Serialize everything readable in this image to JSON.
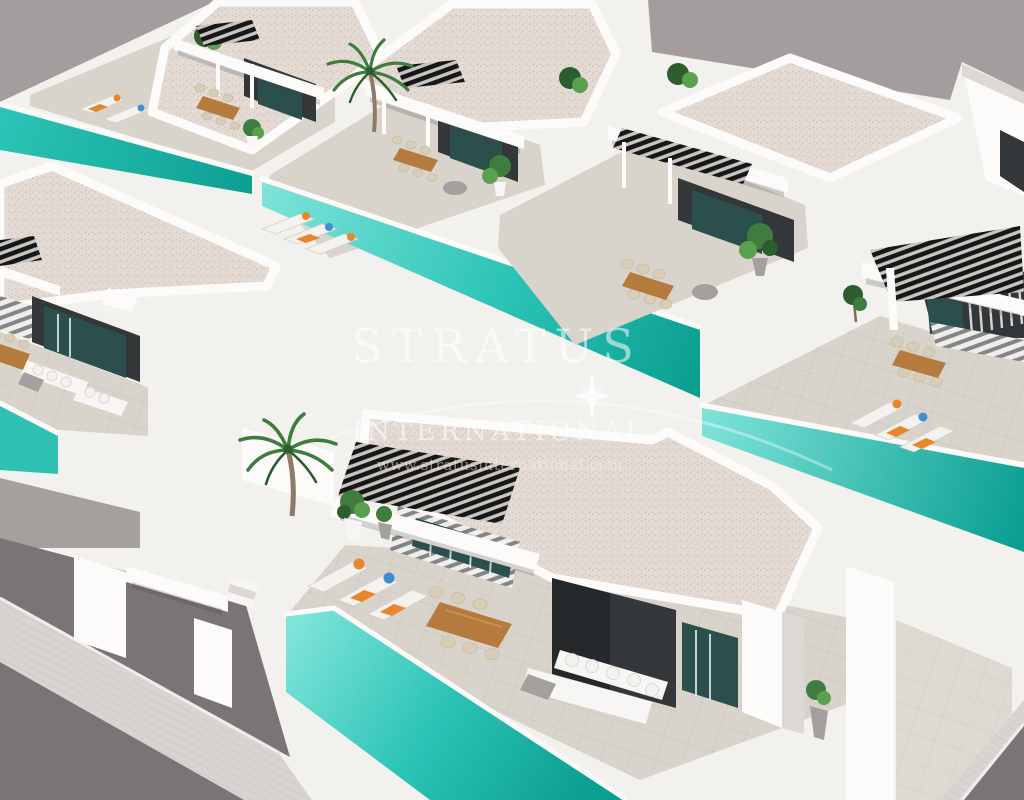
{
  "image_type": "3d-architectural-render",
  "watermark": {
    "brand_line1": "STRATUS",
    "brand_line2": "INTERNATIONAL",
    "website": "www.stratusinternational.com"
  },
  "scene": {
    "description": "Aerial 3D render of a development of modern white flat-roofed villas, each with a private turquoise lap pool, tiled sun terrace, black slatted pergola, dark glazed facade, outdoor dining set, sun loungers with orange and blue cushions, white corner sofas and tropical plants; asphalt road with pale sidewalk at the lower-left and lower-right corners.",
    "villas_visible": 7,
    "pools_visible": 5,
    "palm_trees": 2,
    "pergolas": 6,
    "furniture": [
      "sun loungers with orange and blue cushions",
      "wooden dining tables with rope chairs",
      "white corner sofas",
      "grey daybeds",
      "potted tropical plants"
    ]
  },
  "palette": {
    "sky": "#a49d9d",
    "wall_white": "#f3f1ee",
    "wall_highlight": "#fcfbfa",
    "wall_shade": "#dcd8d5",
    "roof_speckle": "#e4dbd5",
    "roof_dot": "#cdbfb7",
    "terrace_tile": "#d8d4cb",
    "pool_shallow": "#7ee3d9",
    "pool_mid": "#2cc4b6",
    "pool_deep": "#0b9f92",
    "facade_dark": "#33373a",
    "glass_teal": "#2b4f4d",
    "pergola_slat": "#171717",
    "road_asphalt": "#7b7476",
    "sidewalk": "#d8d4d1",
    "wood": "#b57b3c",
    "rattan": "#d8cdb6",
    "leaf_green": "#3f7d3e",
    "cushion_orange": "#e8862e",
    "cushion_blue": "#3e8ed0",
    "watermark_white": "rgba(255,255,255,0.55)"
  }
}
